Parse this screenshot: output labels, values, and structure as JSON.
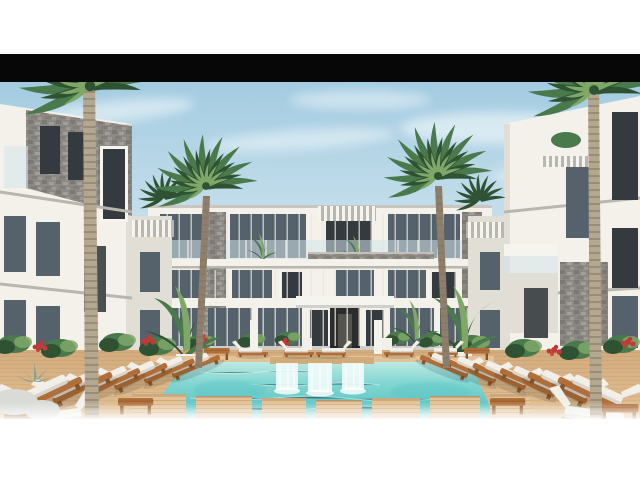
{
  "scene": {
    "type": "photographic-architectural-render",
    "description": "3D rendering of a modern white three-storey resort apartment complex around a courtyard: turquoise swimming pool with twin waterfall weir and wooden stepping platforms, sandy wooden deck, rows of white sun loungers on timber frames, tropical plants with red flowers, and four tall palm trees",
    "elements": {
      "buildings": [
        "central-three-storey-block",
        "left-wing",
        "right-wing",
        "inner-connector-blocks"
      ],
      "palm_trees": 4,
      "small_palms": 2,
      "sun_loungers_left": 7,
      "sun_loungers_right": 7,
      "sun_loungers_far_row": 5,
      "waterfall_streams": 3,
      "pool_platforms": 7
    }
  },
  "layout_bands": {
    "top_margin": "white 0-54px",
    "letterbox_bar": "black 54-82px",
    "photo": "82-420px full width",
    "bottom_margin": "white fade 420-480px"
  },
  "palette": {
    "letterbox": "#070707",
    "sky-top": "#a3cbe1",
    "sky-mid": "#c9e1ec",
    "sky-horizon": "#e7f1f4",
    "cloud": "#f4fafc",
    "building-lit": "#f3f1ea",
    "building-shade": "#e1ded6",
    "building-dark": "#cfccc4",
    "stone-light": "#a8a49d",
    "stone-mid": "#8c8984",
    "stone-dark": "#6e6b66",
    "glass-dark": "#343a3e",
    "glass-mid": "#55626b",
    "rail-glass": "#d4e4ea",
    "water-light": "#c2ebe5",
    "water-mid": "#85d7d2",
    "water-deep": "#5fc6c5",
    "cascade": "#eefbf8",
    "deck-light": "#e3c296",
    "deck-mid": "#d2ab7c",
    "deck-dark": "#b78c5e",
    "wood-frame": "#b06f3a",
    "wood-dark": "#8a5526",
    "cushion": "#f2efe8",
    "cushion-shade": "#d9d5cb",
    "leaf-dark": "#2f5233",
    "leaf-mid": "#4a7a4c",
    "leaf-light": "#7fa768",
    "trunk": "#8d7f6b",
    "trunk-pale": "#b3a78f",
    "trunk-ring": "#7b6c55",
    "flower-red": "#c23a38",
    "rock": "#dadbd6"
  }
}
